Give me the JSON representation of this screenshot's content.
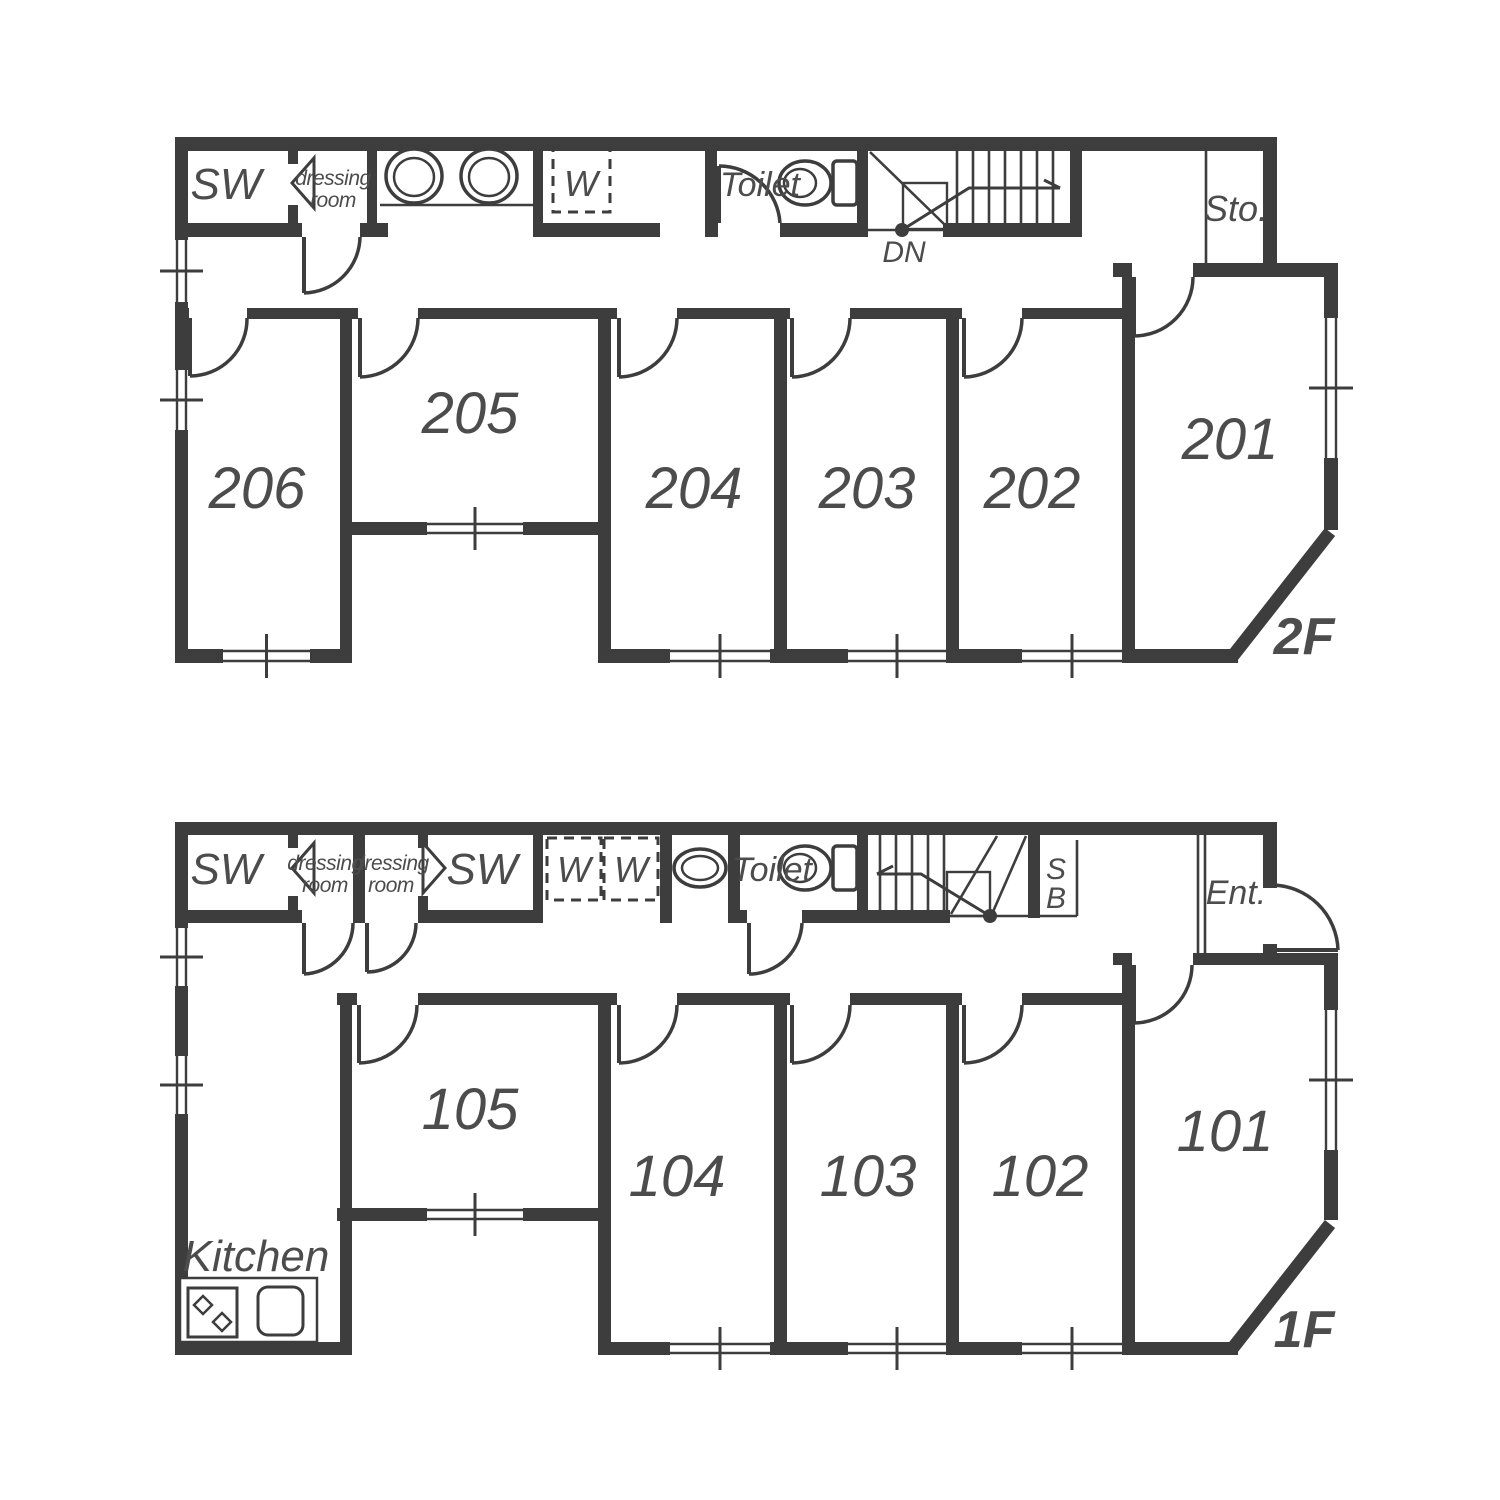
{
  "floor2": {
    "label": "2F",
    "room_numbers": [
      "201",
      "202",
      "203",
      "204",
      "205",
      "206"
    ],
    "labels": {
      "sw": "SW",
      "dressing_line1": "dressing",
      "dressing_line2": "room",
      "toilet": "Toilet",
      "washer": "W",
      "storage": "Sto.",
      "stairs_down": "DN"
    }
  },
  "floor1": {
    "label": "1F",
    "room_numbers": [
      "101",
      "102",
      "103",
      "104",
      "105"
    ],
    "labels": {
      "sw_left": "SW",
      "sw_right": "SW",
      "dressing1_line1": "dressing",
      "dressing1_line2": "room",
      "dressing2_line1": "dressing",
      "dressing2_line2": "room",
      "toilet": "Toilet",
      "washer_left": "W",
      "washer_right": "W",
      "shoebox_line1": "S",
      "shoebox_line2": "B",
      "entrance": "Ent.",
      "kitchen": "Kitchen"
    }
  },
  "colors": {
    "wall": "#3d3d3d",
    "text": "#4c4c4c",
    "background": "#ffffff"
  }
}
